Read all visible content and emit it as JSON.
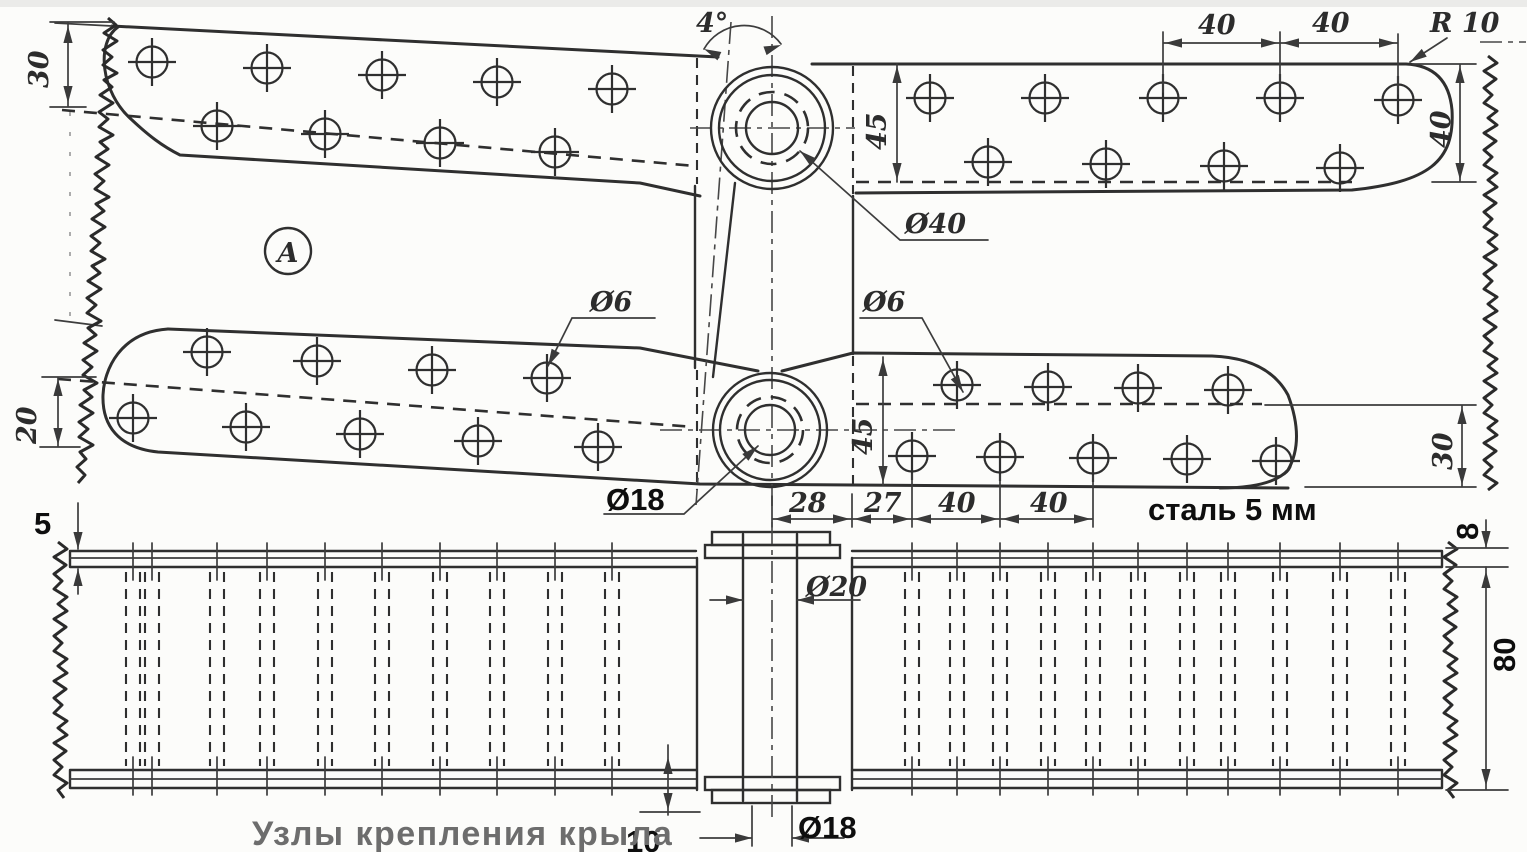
{
  "caption": "Узлы крепления крыла",
  "plan_view": {
    "material_note": "сталь 5 мм",
    "detail_marker": "А",
    "dim_edge_offset_top_left": "30",
    "dim_hinge_angle": "4°",
    "dim_hole_pitch_a": "40",
    "dim_hole_pitch_b": "40",
    "dim_corner_radius": "R 10",
    "dim_plate_width_upper": "45",
    "dim_edge_width_right": "40",
    "dim_boss_diameter": "Ø40",
    "dim_hole_diameter_left": "Ø6",
    "dim_hole_diameter_right": "Ø6",
    "dim_edge_offset_bottom_left": "20",
    "dim_plate_width_lower": "45",
    "dim_edge_offset_bottom_right": "30",
    "dim_pin_diameter": "Ø18",
    "dim_chain_28": "28",
    "dim_chain_27": "27",
    "dim_chain_40_a": "40",
    "dim_chain_40_b": "40"
  },
  "side_view": {
    "dim_plate_thickness": "5",
    "dim_bush_diameter": "Ø20",
    "dim_pin_diameter": "Ø18",
    "dim_flange_offset": "10",
    "dim_edge_thickness": "8",
    "dim_total_height": "80"
  }
}
